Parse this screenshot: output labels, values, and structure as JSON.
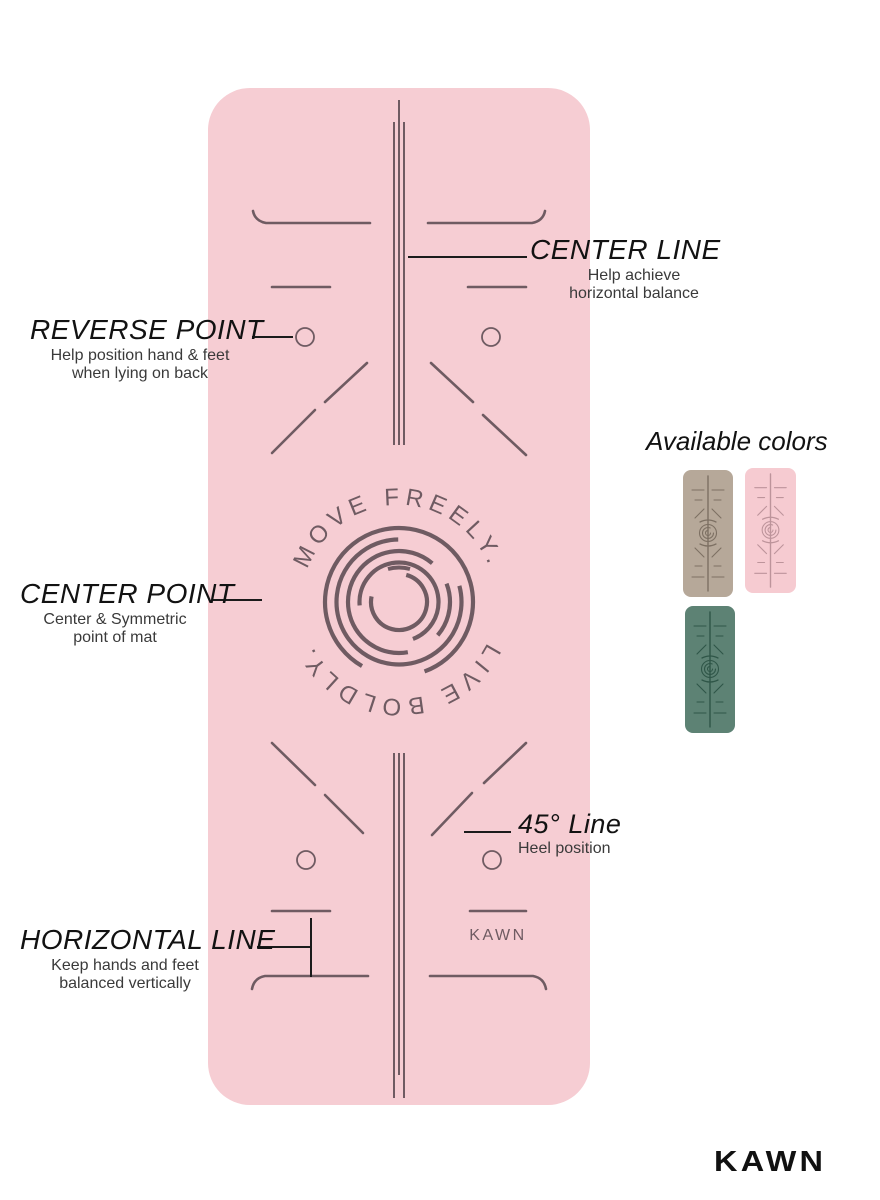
{
  "mat": {
    "color": "#f6cdd3",
    "line_color": "#6f5b62",
    "emblem_top_text": "MOVE FREELY.",
    "emblem_bottom_text": "LIVE BOLDLY.",
    "brand_mark": "KAWN"
  },
  "callouts": {
    "center_line": {
      "title": "CENTER LINE",
      "line1": "Help achieve",
      "line2": "horizontal balance"
    },
    "reverse_point": {
      "title": "REVERSE POINT",
      "line1": "Help position hand & feet",
      "line2": "when lying on back"
    },
    "center_point": {
      "title": "CENTER POINT",
      "line1": "Center & Symmetric",
      "line2": "point of mat"
    },
    "line_45": {
      "title": "45° Line",
      "line1": "Heel position"
    },
    "horizontal_line": {
      "title": "HORIZONTAL LINE",
      "line1": "Keep hands and feet",
      "line2": "balanced vertically"
    }
  },
  "available_colors": {
    "title": "Available colors",
    "swatches": [
      {
        "name": "beige",
        "bg": "#b6a899",
        "line": "#7d7063"
      },
      {
        "name": "pink",
        "bg": "#f6cbd1",
        "line": "#bd949b"
      },
      {
        "name": "green",
        "bg": "#5d8274",
        "line": "#2f5648"
      }
    ]
  },
  "brand": {
    "logo_text": "KAWN"
  }
}
